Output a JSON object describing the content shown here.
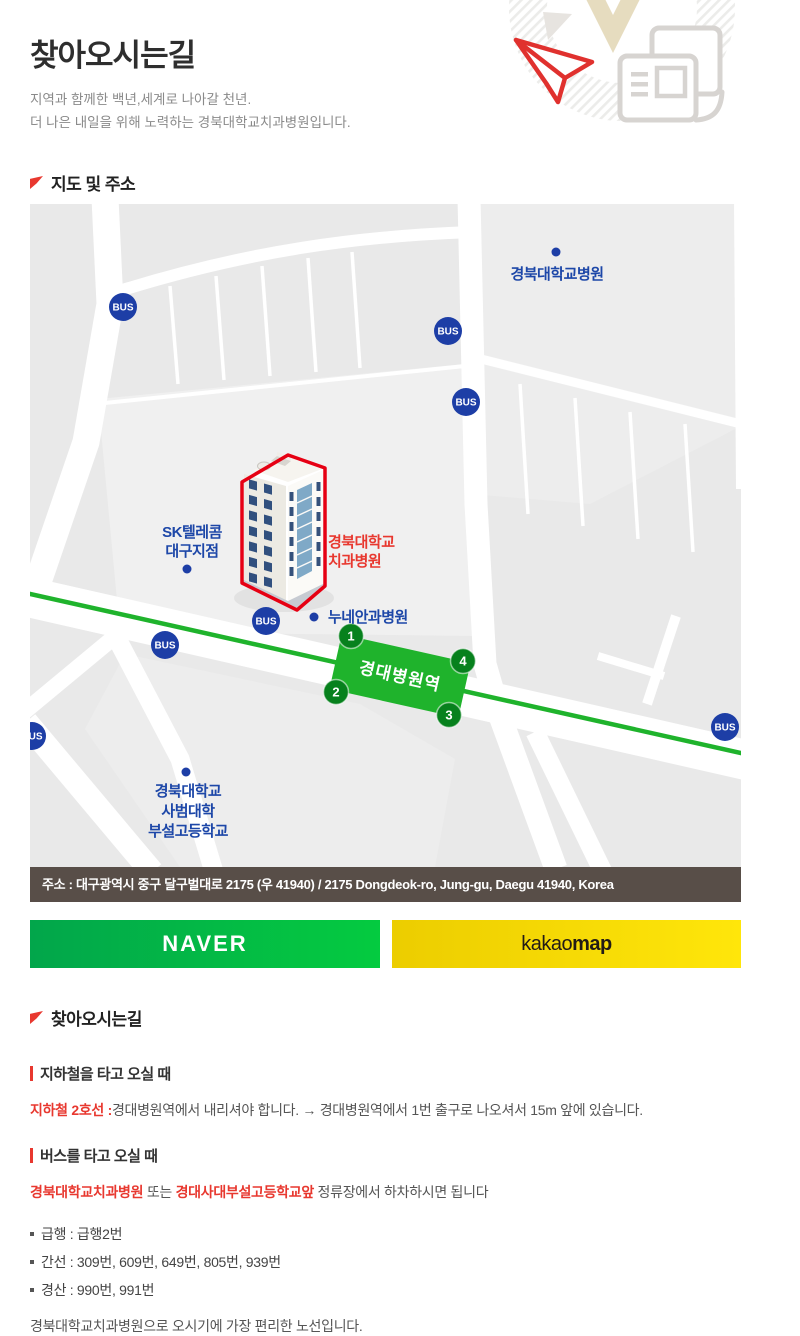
{
  "header": {
    "title": "찾아오시는길",
    "subtitle": [
      "지역과 함께한 백년,세계로 나아갈 천년.",
      "더 나은 내일을 위해 노력하는 경북대학교치과병원입니다."
    ]
  },
  "map_section": {
    "heading": "지도 및 주소",
    "address": "주소 : 대구광역시 중구 달구벌대로 2175 (우 41940) / 2175 Dongdeok-ro, Jung-gu, Daegu 41940, Korea",
    "naver_label": "NAVER",
    "kakao_prefix": "kakao",
    "kakao_suffix": "map",
    "map": {
      "bus_badge": "BUS",
      "station_label": "경대병원역",
      "exit_numbers": [
        "1",
        "2",
        "3",
        "4"
      ],
      "labels": {
        "knu_hospital": "경북대학교병원",
        "sk_telecom": [
          "SK텔레콤",
          "대구지점"
        ],
        "dental_hospital": [
          "경북대학교",
          "치과병원"
        ],
        "nune_eye_hospital": "누네안과병원",
        "knu_high_school": [
          "경북대학교",
          "사범대학",
          "부설고등학교"
        ]
      }
    }
  },
  "directions": {
    "heading": "찾아오시는길",
    "subway": {
      "heading": "지하철을 타고 오실 때",
      "highlight": "지하철 2호선 :",
      "text": "경대병원역에서 내리셔야 합니다. → 경대병원역에서 1번 출구로 나오셔서 15m 앞에 있습니다."
    },
    "bus": {
      "heading": "버스를 타고 오실 때",
      "stop1": "경북대학교치과병원",
      "middle": " 또는 ",
      "stop2": "경대사대부설고등학교앞",
      "tail": " 정류장에서 하차하시면 됩니다",
      "routes": [
        "급행 : 급행2번",
        "간선 : 309번, 609번, 649번, 805번, 939번",
        "경산 : 990번, 991번"
      ],
      "note": "경북대학교치과병원으로 오시기에 가장 편리한 노선입니다."
    }
  },
  "colors": {
    "accent_red": "#e8382f",
    "building_outline_red": "#e60013",
    "label_blue": "#1d47a8",
    "bus_blue": "#1d3ea6",
    "subway_green": "#1fb32c",
    "exit_green": "#07811d",
    "map_background": "#e9e9e9",
    "address_bar": "#584e48",
    "naver_green_start": "#02a64b",
    "naver_green_end": "#04cb40",
    "kakao_yellow_start": "#eccd00",
    "kakao_yellow_end": "#ffe60a"
  }
}
